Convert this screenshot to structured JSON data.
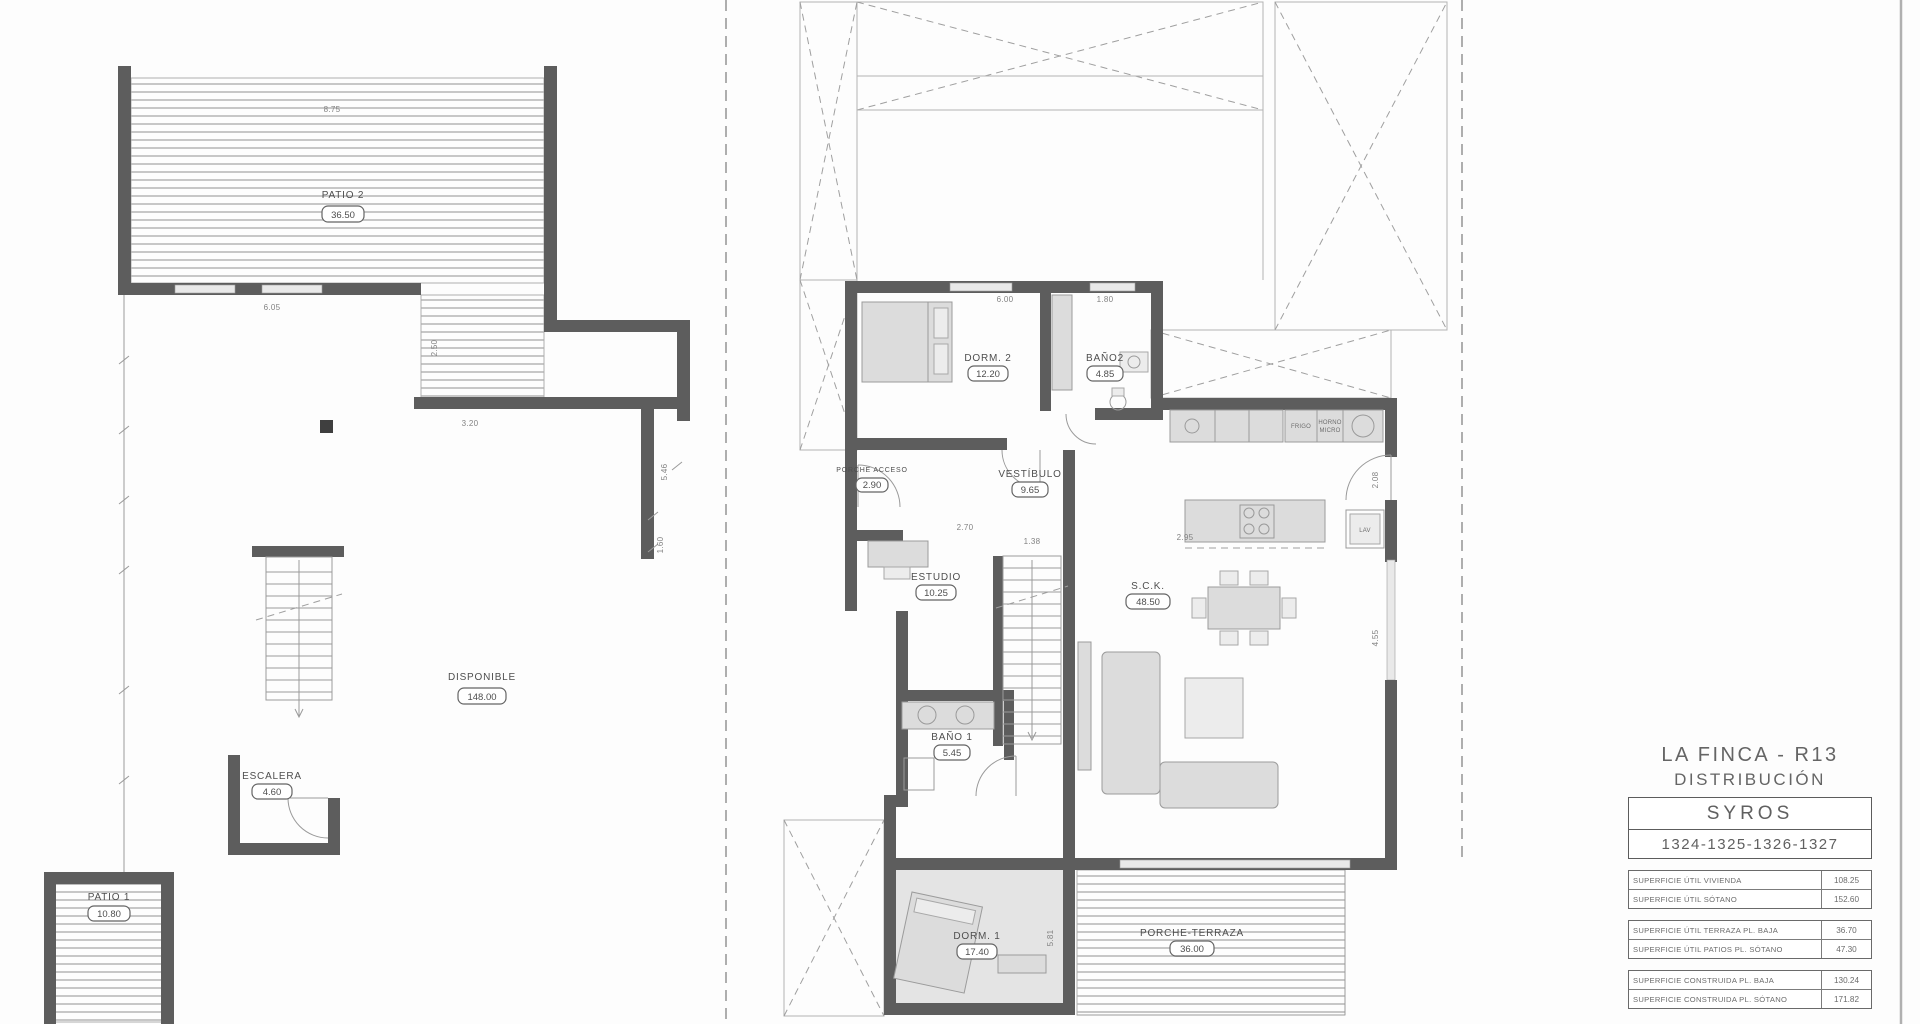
{
  "title_block": {
    "project": "LA FINCA - R13",
    "drawing": "DISTRIBUCIÓN",
    "model": "SYROS",
    "units": "1324-1325-1326-1327",
    "area_tables": [
      {
        "rows": [
          {
            "label": "SUPERFICIE ÚTIL VIVIENDA",
            "value": "108.25"
          },
          {
            "label": "SUPERFICIE ÚTIL SÓTANO",
            "value": "152.60"
          }
        ]
      },
      {
        "rows": [
          {
            "label": "SUPERFICIE ÚTIL TERRAZA PL. BAJA",
            "value": "36.70"
          },
          {
            "label": "SUPERFICIE ÚTIL PATIOS PL. SÓTANO",
            "value": "47.30"
          }
        ]
      },
      {
        "rows": [
          {
            "label": "SUPERFICIE CONSTRUIDA PL. BAJA",
            "value": "130.24"
          },
          {
            "label": "SUPERFICIE CONSTRUIDA PL. SÓTANO",
            "value": "171.82"
          }
        ]
      }
    ]
  },
  "basement_plan": {
    "rooms": [
      {
        "name": "PATIO 2",
        "area": "36.50"
      },
      {
        "name": "DISPONIBLE",
        "area": "148.00"
      },
      {
        "name": "ESCALERA",
        "area": "4.60"
      },
      {
        "name": "PATIO 1",
        "area": "10.80"
      }
    ],
    "dimensions": [
      "8.75",
      "6.05",
      "2.50",
      "3.20",
      "5.46",
      "1.60"
    ]
  },
  "ground_plan": {
    "rooms": [
      {
        "name": "DORM. 2",
        "area": "12.20"
      },
      {
        "name": "BAÑO2",
        "area": "4.85"
      },
      {
        "name": "VESTÍBULO",
        "area": "9.65"
      },
      {
        "name": "PORCHE ACCESO",
        "area": "2.90"
      },
      {
        "name": "ESTUDIO",
        "area": "10.25"
      },
      {
        "name": "S.C.K.",
        "area": "48.50"
      },
      {
        "name": "BAÑO 1",
        "area": "5.45"
      },
      {
        "name": "DORM. 1",
        "area": "17.40"
      },
      {
        "name": "PORCHE-TERRAZA",
        "area": "36.00"
      }
    ],
    "appliances": [
      "FRIGO",
      "HORNO",
      "MICRO",
      "LAV"
    ],
    "dimensions": [
      "6.00",
      "1.80",
      "2.70",
      "1.38",
      "2.95",
      "2.08",
      "4.55",
      "5.81"
    ]
  }
}
